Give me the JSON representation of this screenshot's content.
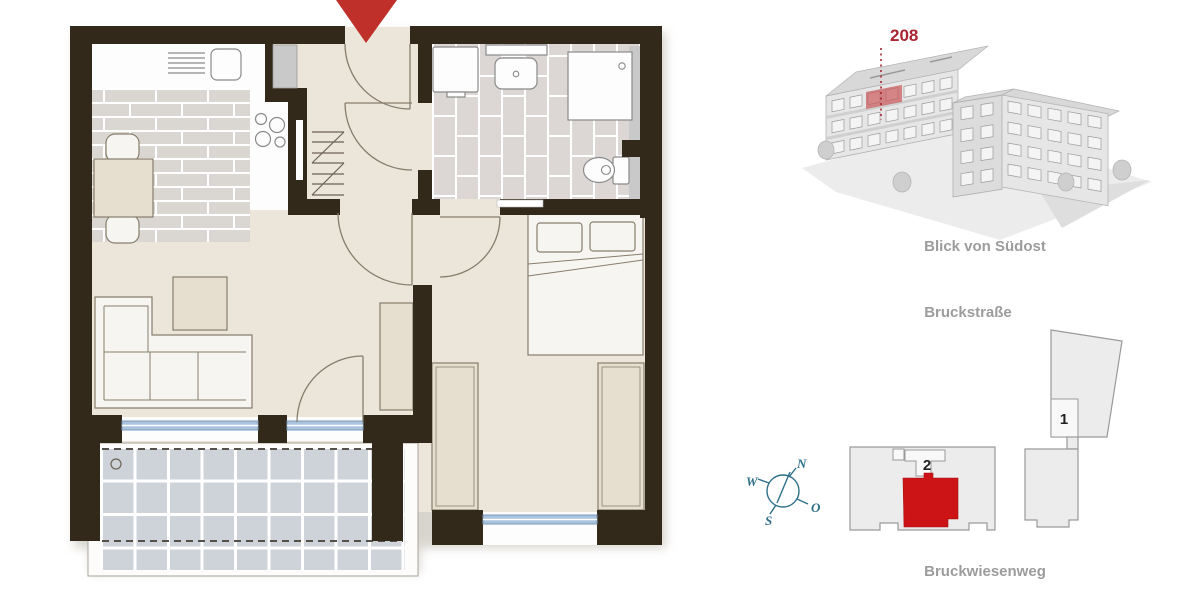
{
  "colors": {
    "wall": "#32291a",
    "floor": "#ece5da",
    "kitchen-tile": "#dad6d2",
    "bath-tile": "#dcd7d5",
    "balcony-tile": "#cdd3d9",
    "furniture": "#e6dfd0",
    "furniture-light": "#f7f5f1",
    "outline": "#877d6c",
    "window-blue": "#aac3df",
    "window-frame": "#7d97b5",
    "arrow-red": "#c0302a",
    "unit-red": "#cc1316",
    "label-red": "#a72530",
    "caption-gray": "#9c9c9c",
    "number-dark": "#222222",
    "compass-teal": "#2d6f8a",
    "site-fill": "#ececec",
    "site-stroke": "#9a9a9a",
    "duct-gray": "#c9c9c9"
  },
  "callout": {
    "unit_number": "208"
  },
  "view_3d": {
    "caption": "Blick von Südost"
  },
  "site_plan": {
    "street_top": "Bruckstraße",
    "street_bottom": "Bruckwiesenweg",
    "building_1": "1",
    "building_2": "2",
    "compass": {
      "n": "N",
      "e": "O",
      "s": "S",
      "w": "W"
    }
  }
}
